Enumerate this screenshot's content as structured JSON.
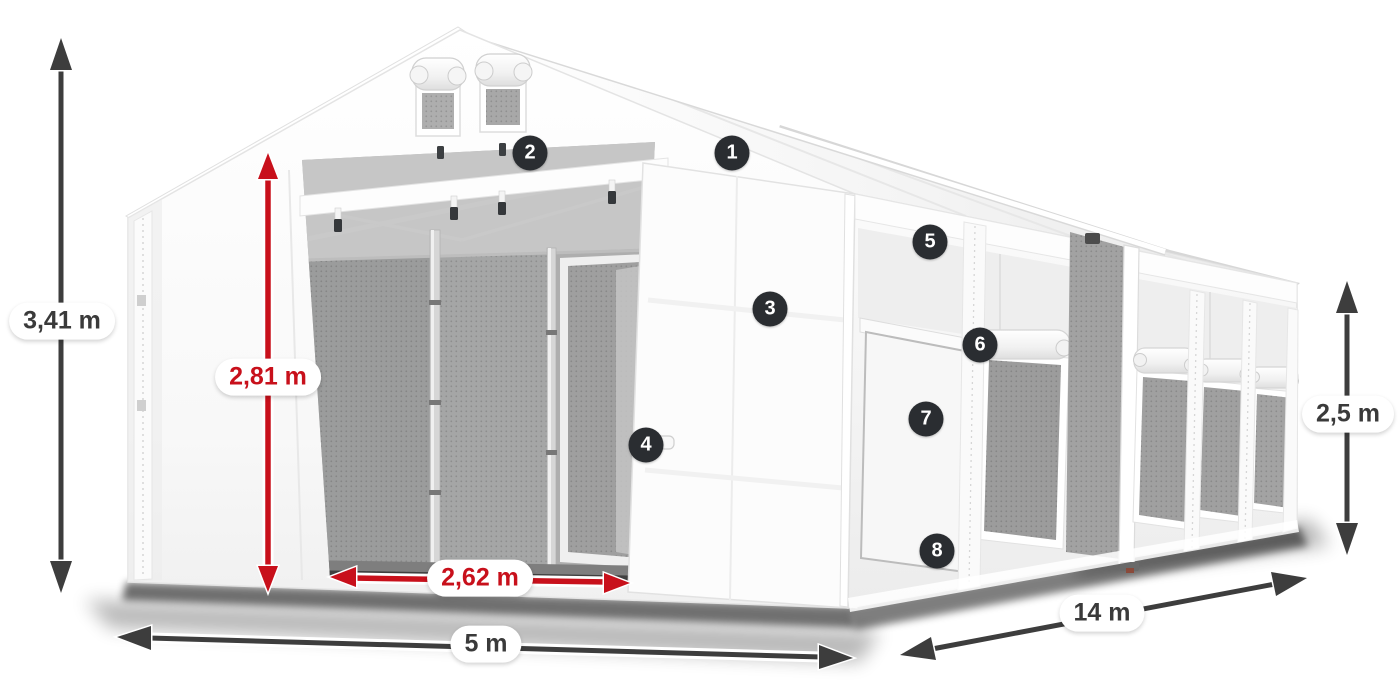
{
  "diagram": {
    "title": "Storage tent dimension diagram",
    "subject": "White tarpaulin tent 5 m x 14 m with entrance and side windows",
    "background_color": "#ffffff",
    "colors": {
      "dimension_dark": "#3d3d3d",
      "dimension_red": "#c8101b",
      "badge_background": "#2a2d31",
      "badge_text": "#ffffff",
      "label_background": "#ffffff",
      "label_text": "#3a3a3a",
      "tent_white": "#f8f8f8",
      "interior_mesh_gray": "#a2a2a2"
    },
    "dimensions": {
      "total_height": {
        "label": "3,41 m",
        "color_style": "dark"
      },
      "clear_entrance_height": {
        "label": "2,81 m",
        "color_style": "red"
      },
      "entrance_width": {
        "label": "2,62 m",
        "color_style": "red"
      },
      "front_width": {
        "label": "5 m",
        "color_style": "dark"
      },
      "side_length": {
        "label": "14 m",
        "color_style": "dark"
      },
      "side_wall_height": {
        "label": "2,5 m",
        "color_style": "dark"
      }
    },
    "callouts": [
      {
        "number": "1"
      },
      {
        "number": "2"
      },
      {
        "number": "3"
      },
      {
        "number": "4"
      },
      {
        "number": "5"
      },
      {
        "number": "6"
      },
      {
        "number": "7"
      },
      {
        "number": "8"
      }
    ]
  }
}
